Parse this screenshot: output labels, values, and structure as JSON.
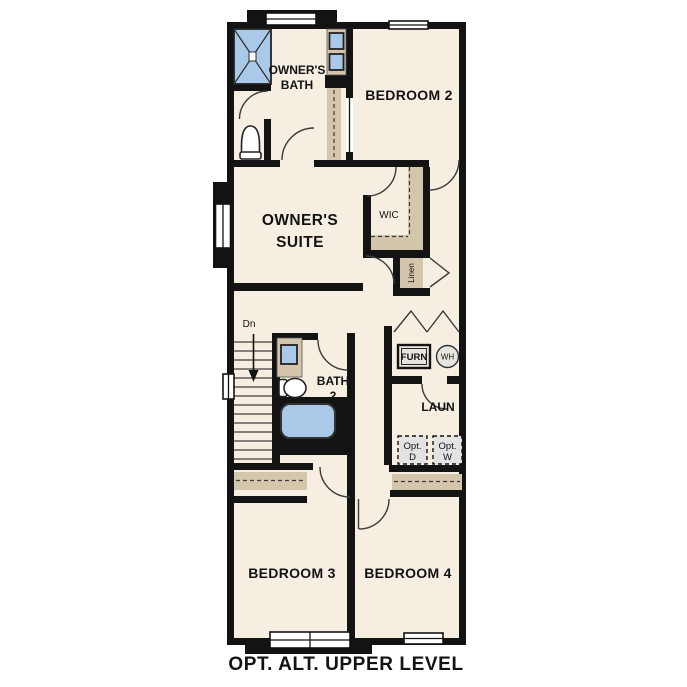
{
  "colors": {
    "background": "#ffffff",
    "wall": "#131313",
    "floor": "#f6eee1",
    "cabinet": "#d3c6aa",
    "fixture_blue": "#aac9e8",
    "appliance_gray": "#e3e3e3",
    "furnace_fill": "#e8e5de"
  },
  "caption": "OPT. ALT. UPPER LEVEL",
  "rooms": {
    "owners_bath": {
      "name": [
        "OWNER'S",
        "BATH"
      ]
    },
    "bedroom_2": {
      "name": "BEDROOM 2"
    },
    "owners_suite": {
      "name": [
        "OWNER'S",
        "SUITE"
      ]
    },
    "walk_in_closet": {
      "name": "WIC"
    },
    "linen": {
      "name": "Linen"
    },
    "stairs": {
      "direction_label": "Dn"
    },
    "bath_2": {
      "name": [
        "BATH",
        "2"
      ]
    },
    "furnace": {
      "name": "FURN"
    },
    "water_heater": {
      "name": "WH"
    },
    "laundry": {
      "name": "LAUN"
    },
    "optional_dryer": {
      "name": [
        "Opt.",
        "D"
      ]
    },
    "optional_washer": {
      "name": [
        "Opt.",
        "W"
      ]
    },
    "bedroom_3": {
      "name": "BEDROOM 3"
    },
    "bedroom_4": {
      "name": "BEDROOM 4"
    }
  }
}
